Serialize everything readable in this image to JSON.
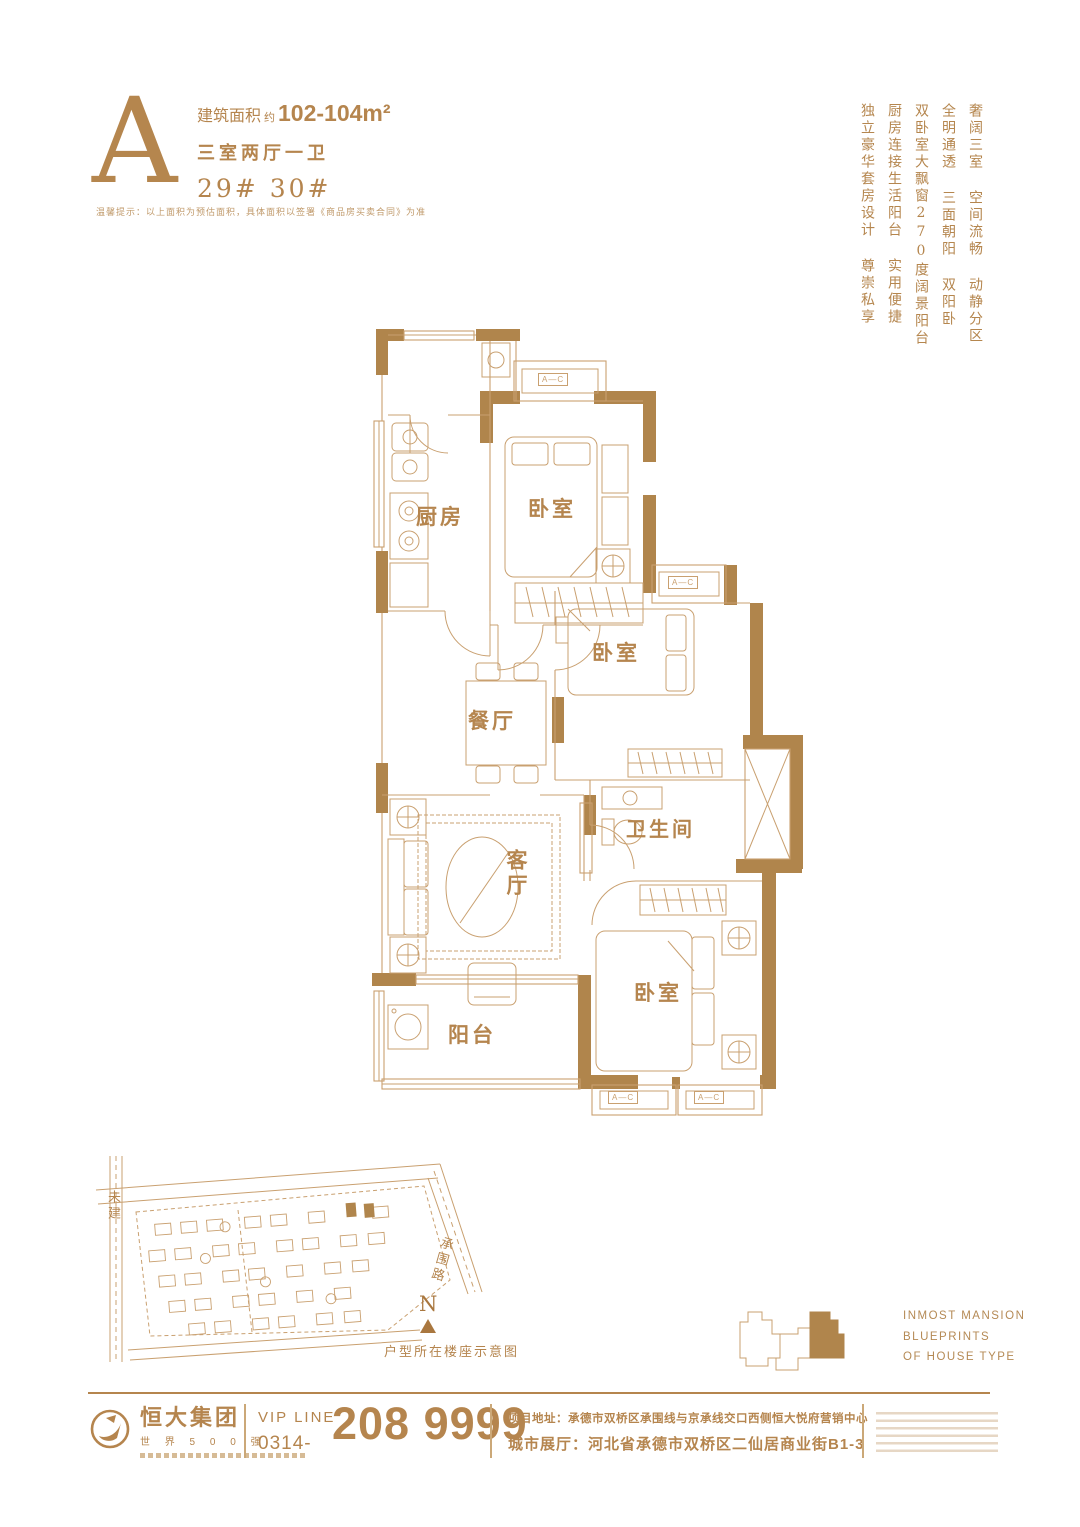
{
  "colors": {
    "accent": "#b5854e",
    "wall": "#b0854c",
    "line": "#c9a070"
  },
  "header": {
    "type_letter": "A",
    "area_label": "建筑面积",
    "area_prefix": "约",
    "area_value": "102-104m²",
    "layout_text": "三室两厅一卫",
    "building_numbers": "29#  30#",
    "disclaimer": "温馨提示：以上面积为预估面积，具体面积以签署《商品房买卖合同》为准"
  },
  "slogans": [
    "奢阔三室 空间流畅 动静分区",
    "全明通透 三面朝阳 双阳卧",
    "双卧室大飘窗270度阔景阳台",
    "厨房连接生活阳台 实用便捷",
    "独立豪华套房设计 尊崇私享"
  ],
  "floorplan": {
    "kitchen": "厨房",
    "bedroom": "卧室",
    "dining": "餐厅",
    "living": "客厅",
    "bathroom": "卫生间",
    "balcony": "阳台",
    "window_code": "A—C"
  },
  "sitemap": {
    "unbuilt": "未建",
    "road": "承围路",
    "compass": "N",
    "caption": "户型所在楼座示意图"
  },
  "keyplan": {
    "line1": "INMOST MANSION",
    "line2": "BLUEPRINTS",
    "line3": "OF HOUSE TYPE"
  },
  "footer": {
    "brand": "恒大集团",
    "brand_sub": "世 界 5 0 0 强",
    "vip_label": "VIP LINE",
    "vip_prefix": "0314-",
    "phone": "208 9999",
    "address_project": "项目地址：承德市双桥区承围线与京承线交口西侧恒大悦府营销中心",
    "address_showroom": "城市展厅：河北省承德市双桥区二仙居商业街B1-3"
  }
}
